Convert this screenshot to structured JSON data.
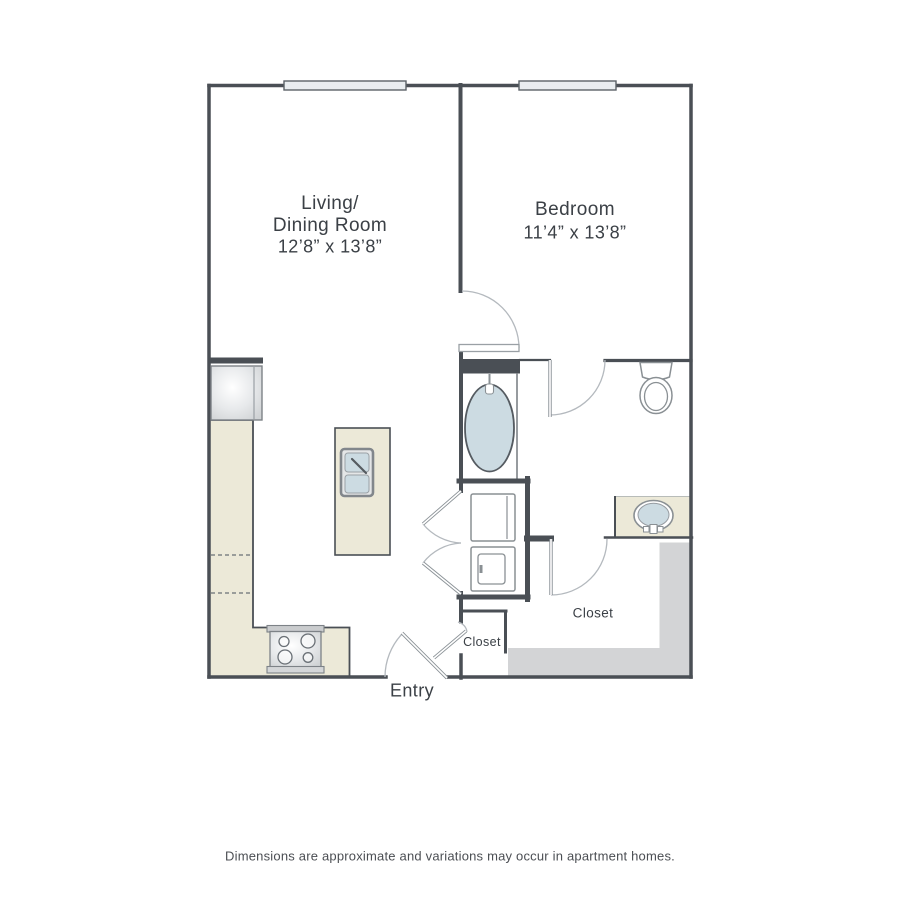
{
  "rooms": {
    "living_dining": {
      "name_line1": "Living/",
      "name_line2": "Dining Room",
      "dimensions": "12’8” x 13’8”"
    },
    "bedroom": {
      "name": "Bedroom",
      "dimensions": "11’4” x 13’8”"
    },
    "walk_in_closet": {
      "name": "Closet"
    },
    "entry_closet": {
      "name": "Closet"
    },
    "entry": {
      "name": "Entry"
    }
  },
  "fixtures": [
    "refrigerator",
    "kitchen-counter",
    "dishwasher-dashed-outline",
    "stove-range",
    "kitchen-island",
    "double-basin-sink",
    "bathtub",
    "toilet",
    "vanity-sink",
    "stacked-washer",
    "stacked-dryer",
    "walk-in-closet-shelving",
    "window",
    "window",
    "hinged-doors",
    "double-closet-doors",
    "entry-door"
  ],
  "colors": {
    "wall": "#4a4f55",
    "counter": "#ece9d8",
    "water_fixture": "#ccdbe2",
    "shelving": "#d3d4d6",
    "window_fill": "#e9edf0",
    "label_text": "#3b4046",
    "disclaimer_text": "#4b4e53"
  },
  "footer": {
    "disclaimer": "Dimensions are approximate and variations may occur in apartment homes."
  }
}
